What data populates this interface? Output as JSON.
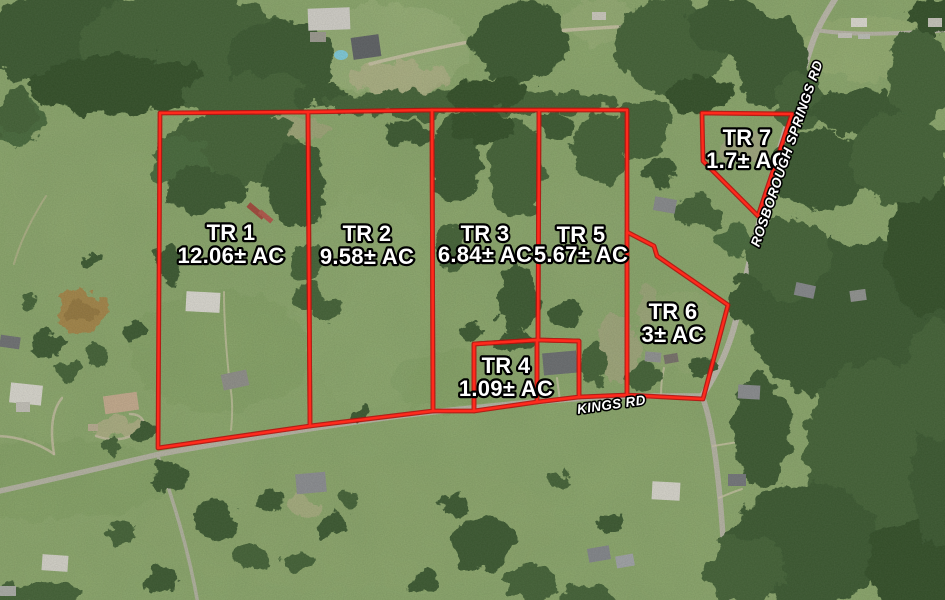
{
  "map": {
    "description": "Aerial tract map with surveyed parcel boundaries",
    "boundary_color": "#ff2a1c",
    "boundary_casing_color": "#b51410",
    "label_text_color": "#ffffff",
    "label_outline_color": "#000000"
  },
  "tracts": [
    {
      "name": "TR 1",
      "acreage": "12.06± AC"
    },
    {
      "name": "TR 2",
      "acreage": "9.58± AC"
    },
    {
      "name": "TR 3",
      "acreage": "6.84± AC"
    },
    {
      "name": "TR 4",
      "acreage": "1.09± AC"
    },
    {
      "name": "TR 5",
      "acreage": "5.67± AC"
    },
    {
      "name": "TR 6",
      "acreage": "3± AC"
    },
    {
      "name": "TR 7",
      "acreage": "1.7± AC"
    }
  ],
  "roads": [
    {
      "name": "KINGS RD"
    },
    {
      "name": "ROSBOROUGH SPRINGS RD"
    }
  ]
}
